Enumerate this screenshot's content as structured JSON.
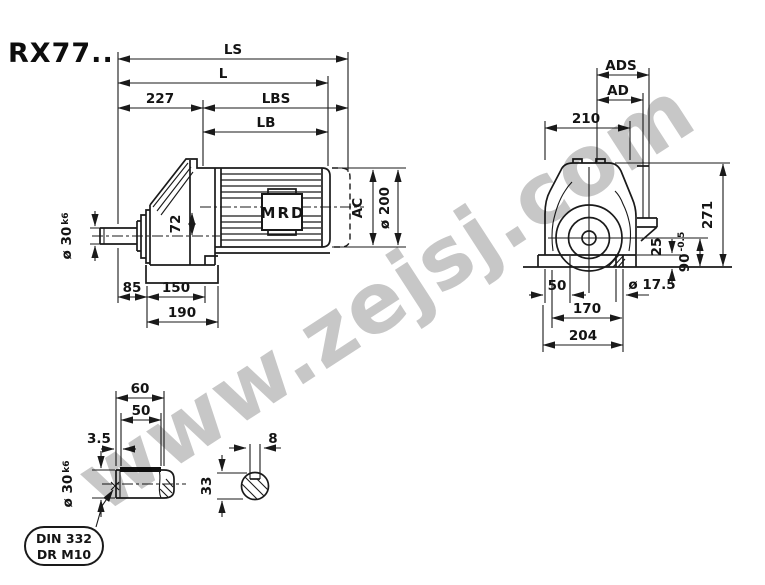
{
  "title": "RX77..",
  "watermark": "www.zejsj.com",
  "colors": {
    "line": "#1a1a1a",
    "watermark": "#c7c7c7",
    "background": "#ffffff"
  },
  "side_view": {
    "brand": "MRD",
    "dims": {
      "ls": "LS",
      "l": "L",
      "d227": "227",
      "lbs": "LBS",
      "lb": "LB",
      "shaft_dia": "ø 30",
      "shaft_tol": "k6",
      "offset": "72",
      "ac": "AC",
      "motor_dia": "ø 200",
      "d85": "85",
      "d150": "150",
      "d190": "190"
    }
  },
  "front_view": {
    "dims": {
      "ads": "ADS",
      "ad": "AD",
      "d210": "210",
      "d271": "271",
      "d90": "90",
      "d90_tol": "-0.5",
      "d25": "25",
      "hole": "ø 17.5",
      "d50": "50",
      "d170": "170",
      "d204": "204"
    }
  },
  "shaft_detail": {
    "dims": {
      "d60": "60",
      "d50": "50",
      "d35": "3.5",
      "shaft_dia": "ø 30",
      "shaft_tol": "k6"
    },
    "callout": {
      "line1": "DIN 332",
      "line2": "DR M10"
    }
  },
  "key_section": {
    "dims": {
      "d8": "8",
      "d33": "33"
    }
  }
}
